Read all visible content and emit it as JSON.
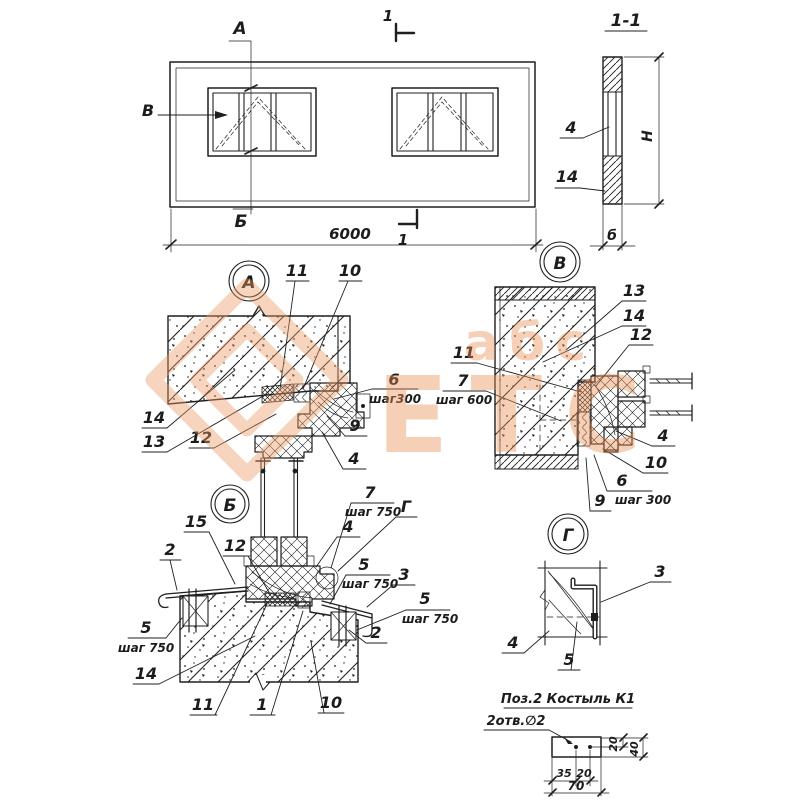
{
  "plan": {
    "mark_a": "А",
    "mark_b": "Б",
    "mark_v": "В",
    "cut": "1",
    "dim_width": "6000"
  },
  "section11": {
    "title": "1-1",
    "c4": "4",
    "c14": "14",
    "dim_h": "Н",
    "dim_b": "б"
  },
  "detail_a": {
    "marker": "А",
    "c11": "11",
    "c10": "10",
    "c6": "6",
    "c6_note": "шаг300",
    "c9": "9",
    "c4": "4",
    "c14": "14",
    "c13": "13",
    "c12": "12"
  },
  "detail_v": {
    "marker": "В",
    "c13": "13",
    "c14": "14",
    "c12": "12",
    "c11": "11",
    "c7": "7",
    "c7_note": "шаг 600",
    "c4": "4",
    "c10": "10",
    "c6": "6",
    "c6_note": "шаг 300",
    "c9": "9"
  },
  "detail_b": {
    "marker": "Б",
    "c15": "15",
    "c12": "12",
    "c2_left": "2",
    "c7": "7",
    "c7_note": "шаг 750",
    "cg": "Г",
    "c4": "4",
    "c5_mid": "5",
    "c5_mid_note": "шаг 750",
    "c3": "3",
    "c5_right": "5",
    "c5_right_note": "шаг 750",
    "c2_right": "2",
    "c5_left": "5",
    "c5_left_note": "шаг 750",
    "c14": "14",
    "c11": "11",
    "c1": "1",
    "c10": "10"
  },
  "detail_g": {
    "marker": "Г",
    "c3": "3",
    "c4": "4",
    "c5": "5"
  },
  "pos2": {
    "title": "Поз.2  Костыль К1",
    "note": "2отв.∅2",
    "dim_20_top": "20",
    "dim_40": "40",
    "dim_35": "35",
    "dim_20_bottom": "20",
    "dim_70": "70"
  },
  "watermark": {
    "small_text": "абс",
    "big_text": "ЕТС",
    "color": "#eb9a63"
  }
}
